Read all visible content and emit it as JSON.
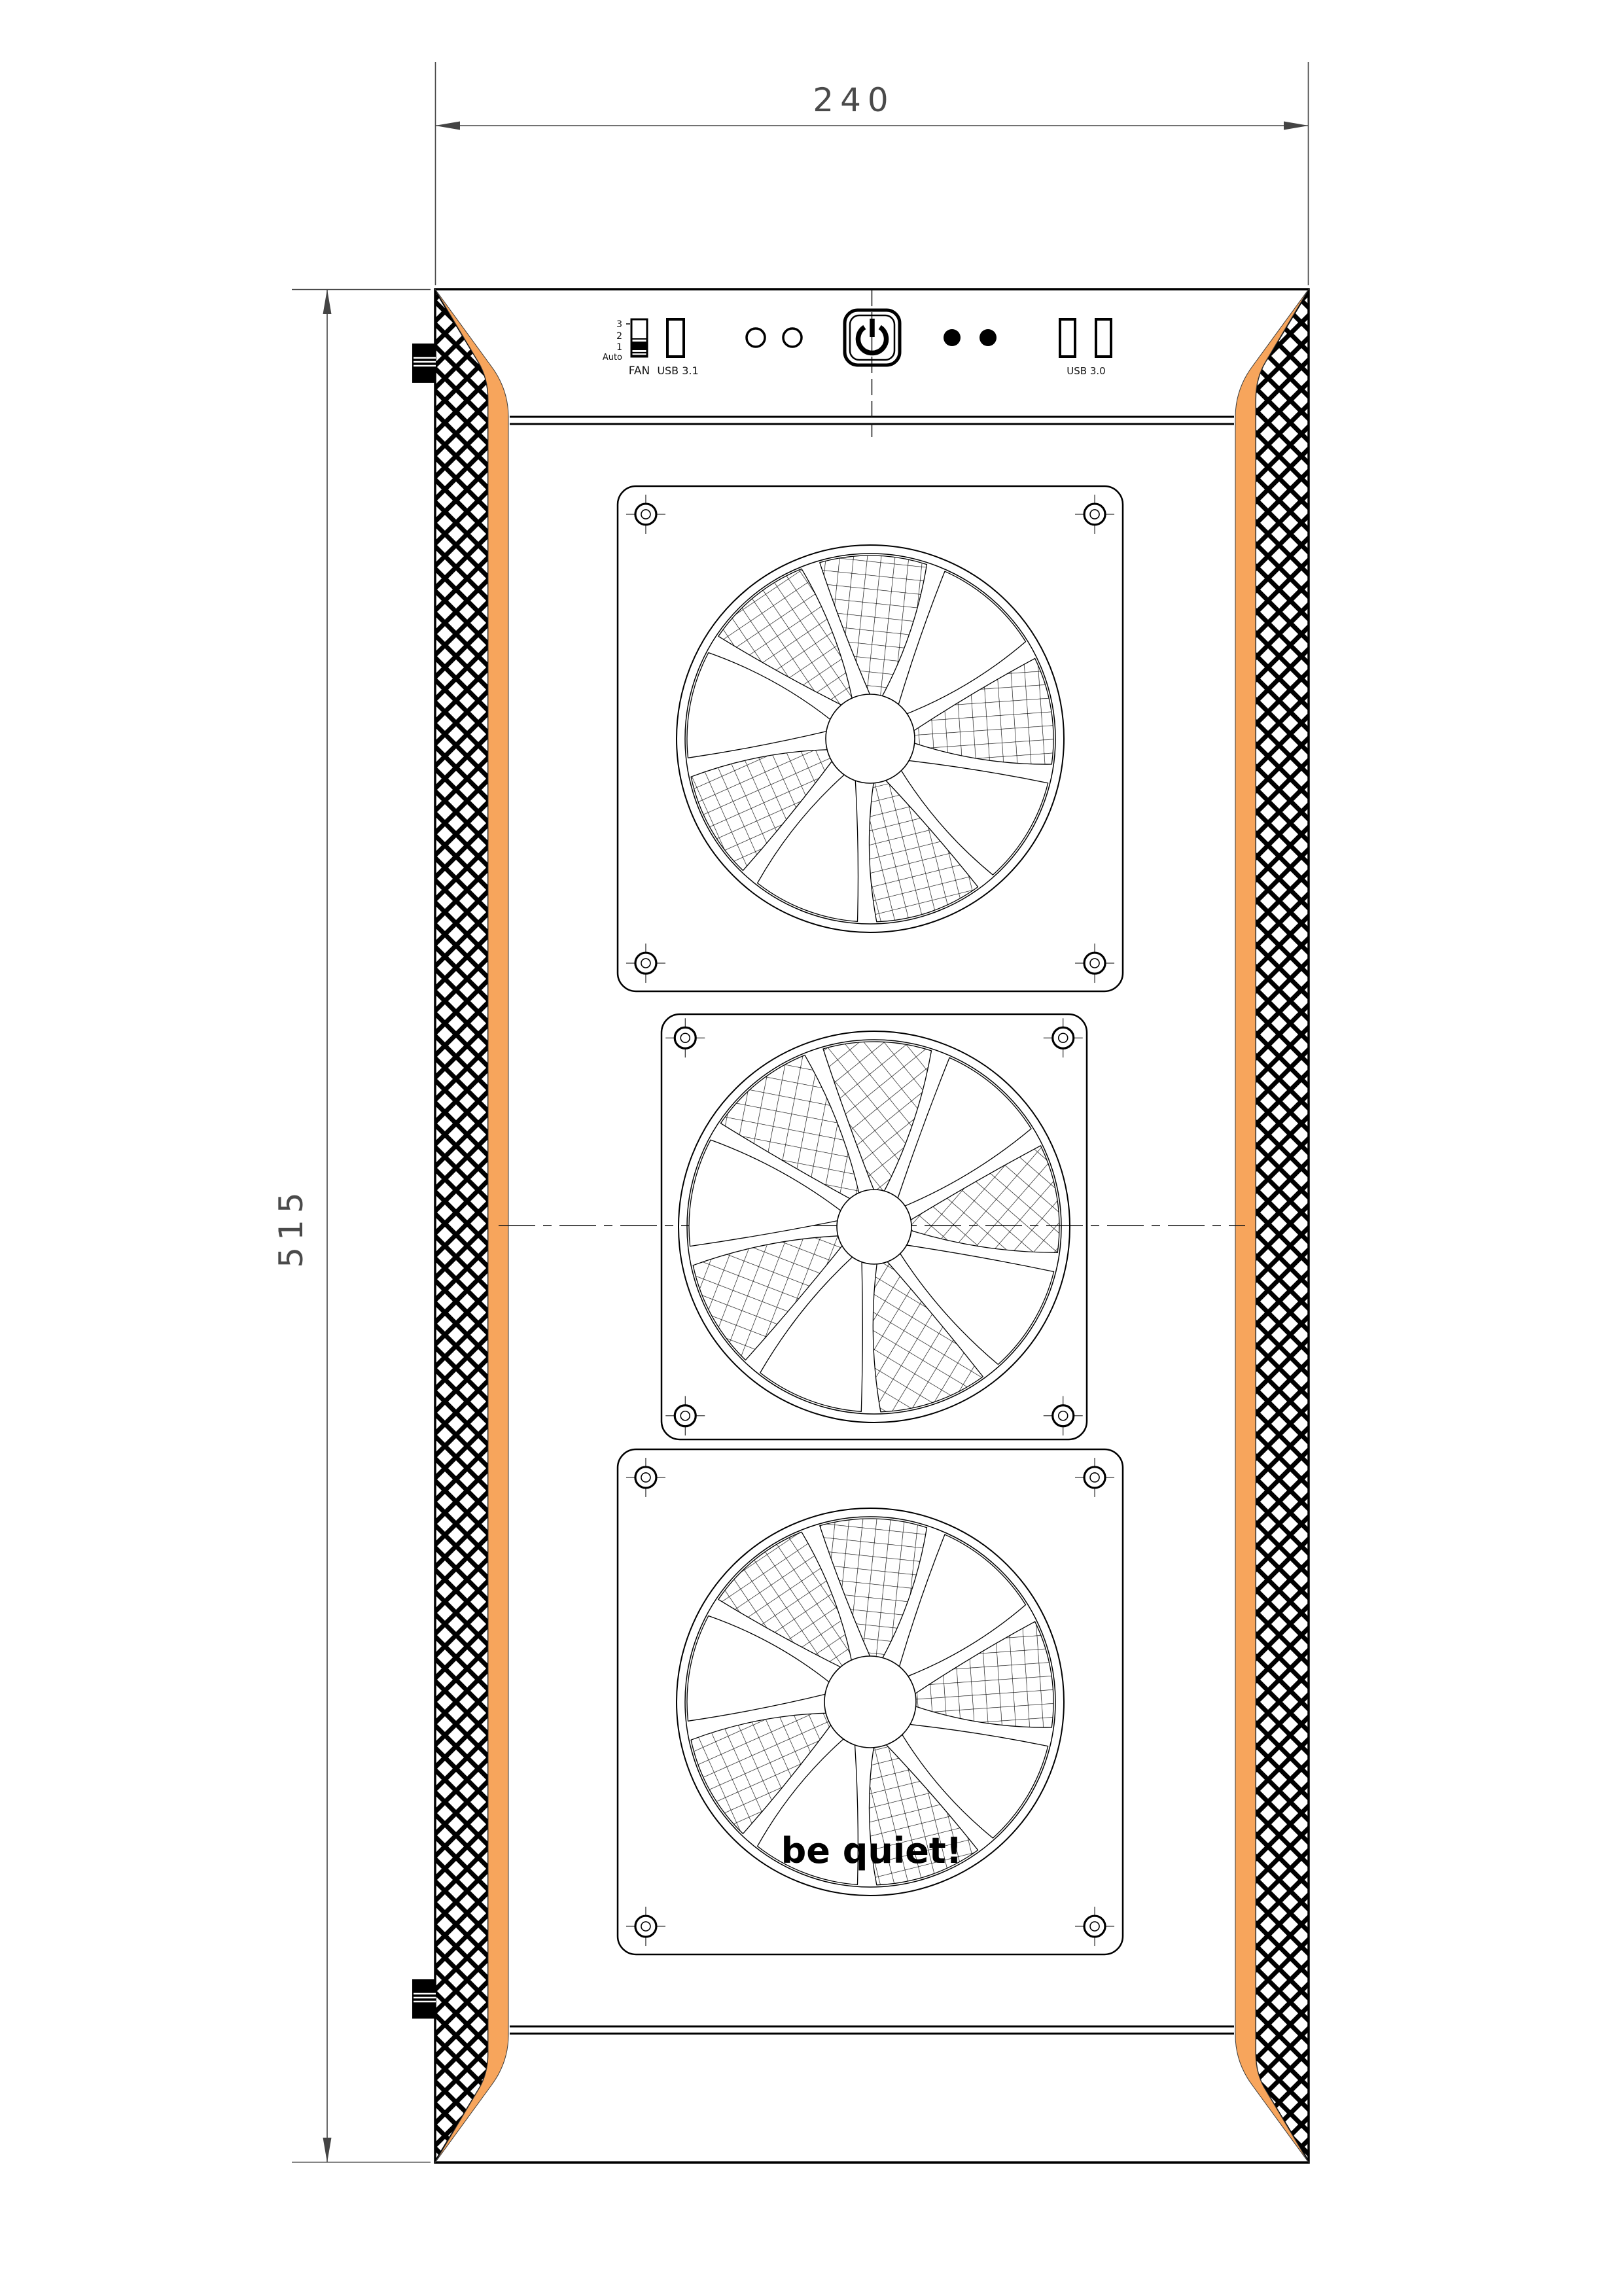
{
  "drawing": {
    "dimensions": {
      "width_mm": "240",
      "height_mm": "515"
    },
    "top_panel": {
      "fan_switch": {
        "label": "FAN",
        "positions": [
          "3",
          "2",
          "1",
          "Auto"
        ]
      },
      "usb31": {
        "label": "USB 3.1"
      },
      "usb30": {
        "label": "USB 3.0"
      }
    },
    "logo": "be quiet!",
    "icons": {
      "power": "power-icon"
    },
    "colors": {
      "accent_orange": "#F7A55C",
      "line": "#000000",
      "dimension": "#444444"
    }
  }
}
